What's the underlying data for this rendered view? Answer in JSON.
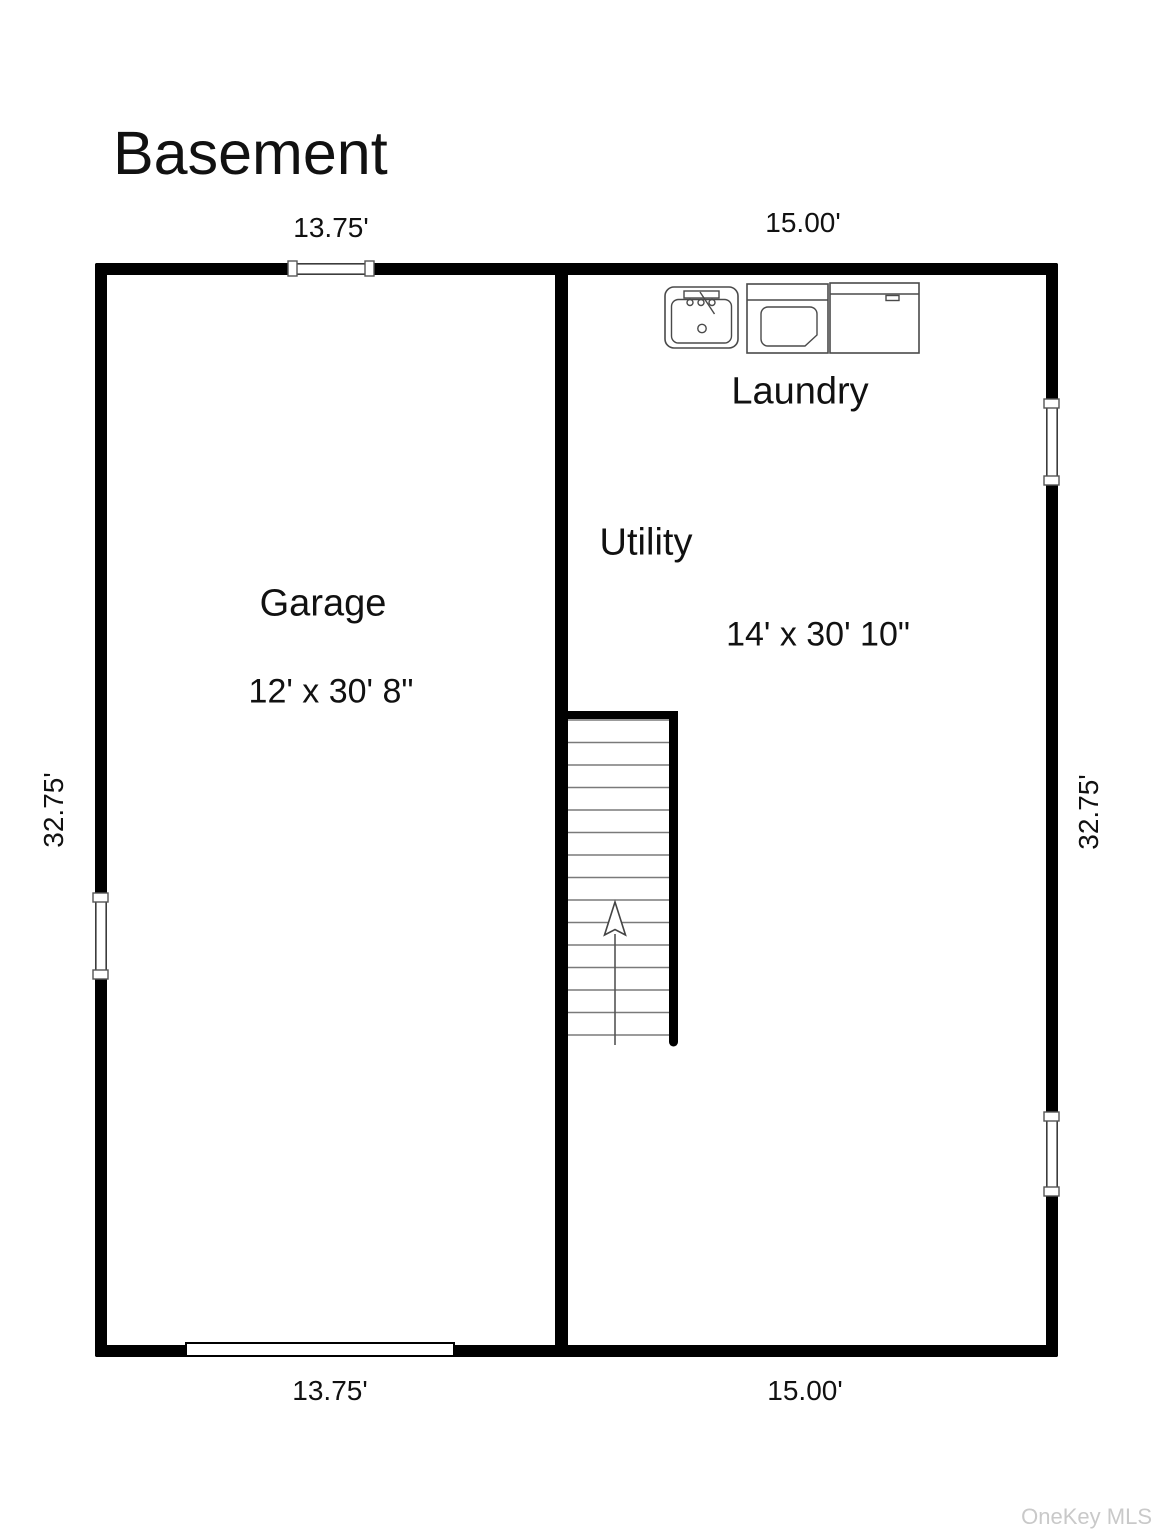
{
  "title": "Basement",
  "watermark": "OneKey MLS",
  "dimensions": {
    "top_left": "13.75'",
    "top_right": "15.00'",
    "bottom_left": "13.75'",
    "bottom_right": "15.00'",
    "side_left": "32.75'",
    "side_right": "32.75'"
  },
  "rooms": {
    "garage": {
      "label": "Garage",
      "size": "12' x 30' 8\""
    },
    "utility": {
      "label": "Utility",
      "size": "14' x 30' 10\""
    },
    "laundry": {
      "label": "Laundry"
    }
  },
  "stairs": {
    "tread_count": 15,
    "direction": "up"
  },
  "fixtures": [
    "sink",
    "washer",
    "dryer"
  ],
  "colors": {
    "wall": "#000000",
    "tread": "#7a7a7a",
    "fixture_outline": "#4a4a4a",
    "watermark": "#c9c9c9"
  }
}
